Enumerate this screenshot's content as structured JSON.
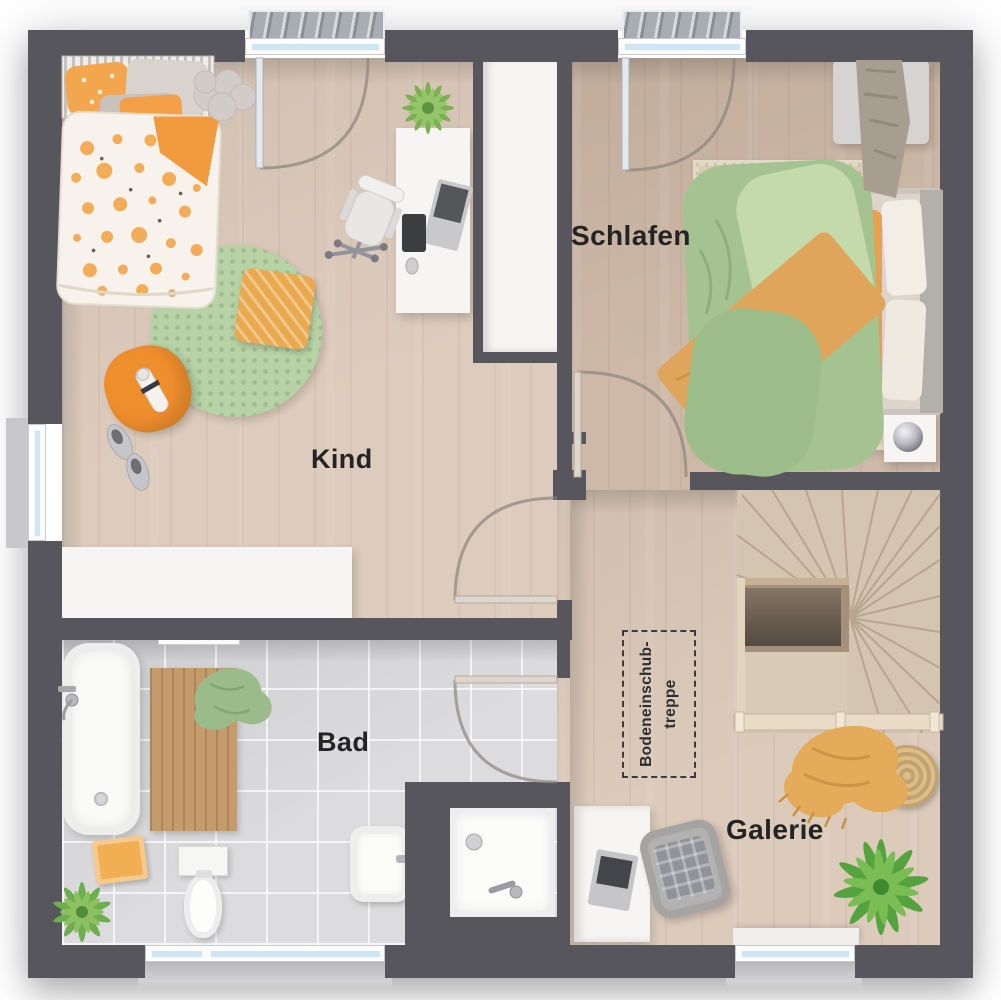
{
  "title": "Obergeschoss Grundriss",
  "rooms": {
    "kind": {
      "label": "Kind"
    },
    "schlafen": {
      "label": "Schlafen"
    },
    "bad": {
      "label": "Bad"
    },
    "galerie": {
      "label": "Galerie"
    }
  },
  "annotations": {
    "attic_stairs": {
      "line1": "Bodeneinschub-",
      "line2": "treppe"
    }
  },
  "colors": {
    "wall": "#56565c",
    "wood_light": "#dccaba",
    "wood_mid": "#ccb6a4",
    "tile": "#dadadd",
    "accent_orange": "#f09d43",
    "accent_green": "#a8c795",
    "glass": "#cfe5f2",
    "stair_wood": "#d4c5b1"
  }
}
